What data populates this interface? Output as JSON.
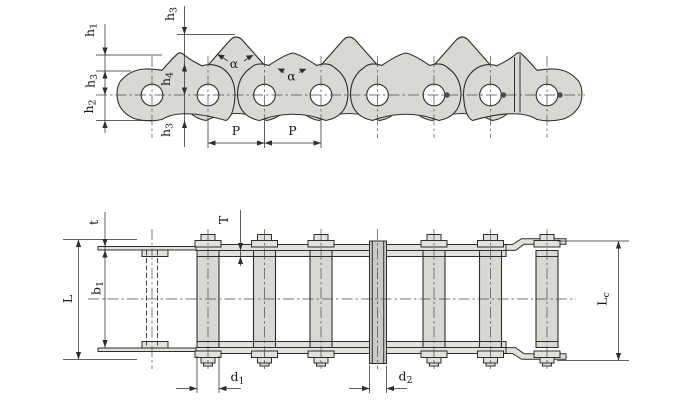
{
  "drawing": {
    "description": "roller-chain-engineering-drawing",
    "colors": {
      "background": "#ffffff",
      "stroke": "#2e2e2e",
      "plate_fill": "#d7dad2",
      "bar_fill": "#e0e2db",
      "bushing_fill": "#c9ccc5",
      "centerline": "#4a4a4a"
    },
    "labels": {
      "h1": {
        "main": "h",
        "sub": "1"
      },
      "h3_left": {
        "main": "h",
        "sub": "3"
      },
      "h2": {
        "main": "h",
        "sub": "2"
      },
      "h3_top": {
        "main": "h",
        "sub": "3"
      },
      "h4": {
        "main": "h",
        "sub": "4"
      },
      "h3_bottom": {
        "main": "h",
        "sub": "3"
      },
      "alpha_1": {
        "main": "α",
        "sub": ""
      },
      "alpha_2": {
        "main": "α",
        "sub": ""
      },
      "pitch_1": {
        "main": "P",
        "sub": ""
      },
      "pitch_2": {
        "main": "P",
        "sub": ""
      },
      "t_lower": {
        "main": "t",
        "sub": ""
      },
      "t_upper": {
        "main": "T",
        "sub": ""
      },
      "l_overall": {
        "main": "L",
        "sub": ""
      },
      "b1": {
        "main": "b",
        "sub": "1"
      },
      "lc": {
        "main": "L",
        "sub": "c"
      },
      "d1": {
        "main": "d",
        "sub": "1"
      },
      "d2": {
        "main": "d",
        "sub": "2"
      }
    }
  }
}
